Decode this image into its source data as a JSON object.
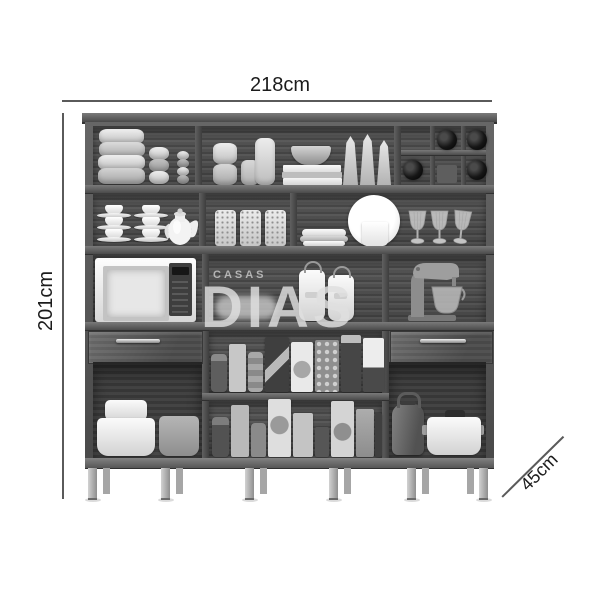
{
  "page": {
    "background": "#ffffff",
    "description": "grayscale product photo of a kitchen cupboard with dimension annotations"
  },
  "dimensions": {
    "width_label": "218cm",
    "height_label": "201cm",
    "depth_label": "45cm"
  },
  "watermark": {
    "top": "CASAS",
    "main": "DIAS"
  },
  "colors": {
    "background": "#ffffff",
    "wood_frame": "#4f4f4f",
    "wood_back_panel": "#4a4a4a",
    "annotation_line": "#5a5a5a",
    "annotation_text": "#1c1c1c",
    "watermark_text": "#e0e0e0",
    "legs": "#b5b5b5",
    "wine_bottle": "#161616",
    "whiteware": "#f5f5f5"
  },
  "cabinet": {
    "name": "kitchen cabinet",
    "top_shelf_items": [
      "stacked-round-containers",
      "small-jar-stack",
      "spice-stack",
      "canister-stack",
      "candles",
      "bowl-on-books",
      "flour-sacks",
      "wine-rack-with-bottles"
    ],
    "second_shelf_items": [
      "teacup-stacks",
      "teapot",
      "decorated-jars",
      "plate-stack",
      "display-plate-with-mug",
      "wine-glasses"
    ],
    "counter_items": [
      "microwave",
      "white-jugs",
      "stand-mixer"
    ],
    "drawer_count": 2,
    "pantry_items": [
      "cans",
      "cereal-boxes",
      "food-packages"
    ],
    "base_items": [
      "stacked-white-pots",
      "gray-pot",
      "electric-kettle",
      "white-pot-with-lid"
    ]
  }
}
